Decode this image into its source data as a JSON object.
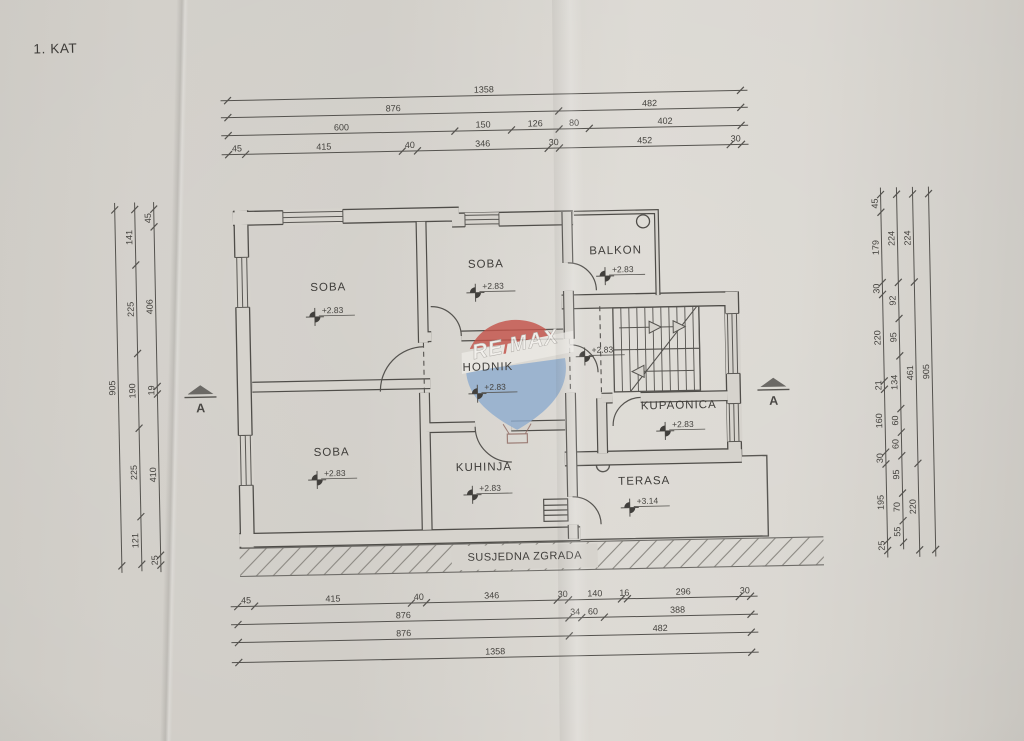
{
  "page_title": "1. KAT",
  "watermark": {
    "re": "RE",
    "slash": "/",
    "max": "MAX",
    "balloon_red": "#c4544b",
    "balloon_blue": "#8fadcf"
  },
  "floorplan": {
    "section_label": "A",
    "neighbor_building_label": "SUSJEDNA ZGRADA",
    "hall_marker_elevation": "+2.83",
    "rooms": [
      {
        "id": "soba-1",
        "label": "SOBA",
        "elevation": "+2.83"
      },
      {
        "id": "soba-2",
        "label": "SOBA",
        "elevation": "+2.83"
      },
      {
        "id": "balkon",
        "label": "BALKON",
        "elevation": "+2.83"
      },
      {
        "id": "hodnik",
        "label": "HODNIK",
        "elevation": "+2.83"
      },
      {
        "id": "kupaonica",
        "label": "KUPAONICA",
        "elevation": "+2.83"
      },
      {
        "id": "soba-3",
        "label": "SOBA",
        "elevation": "+2.83"
      },
      {
        "id": "kuhinja",
        "label": "KUHINJA",
        "elevation": "+2.83"
      },
      {
        "id": "terasa",
        "label": "TERASA",
        "elevation": "+3.14"
      }
    ]
  },
  "dimensions": {
    "top_rows": [
      [
        1358
      ],
      [
        876,
        482
      ],
      [
        600,
        150,
        126,
        80,
        402
      ],
      [
        45,
        415,
        40,
        346,
        30,
        452,
        30
      ]
    ],
    "bottom_rows": [
      [
        45,
        415,
        40,
        346,
        30,
        140,
        16,
        296,
        30
      ],
      [
        876,
        34,
        60,
        388
      ],
      [
        876,
        482
      ],
      [
        1358
      ]
    ],
    "left_columns": [
      [
        905
      ],
      [
        141,
        225,
        190,
        225,
        121
      ],
      [
        45,
        406,
        19,
        410,
        25
      ]
    ],
    "right_columns": [
      [
        45,
        179,
        30,
        220,
        21,
        160,
        30,
        195,
        25
      ],
      [
        224,
        92,
        95,
        134,
        60,
        60,
        95,
        70,
        55
      ],
      [
        224,
        461,
        220
      ],
      [
        905
      ]
    ]
  }
}
